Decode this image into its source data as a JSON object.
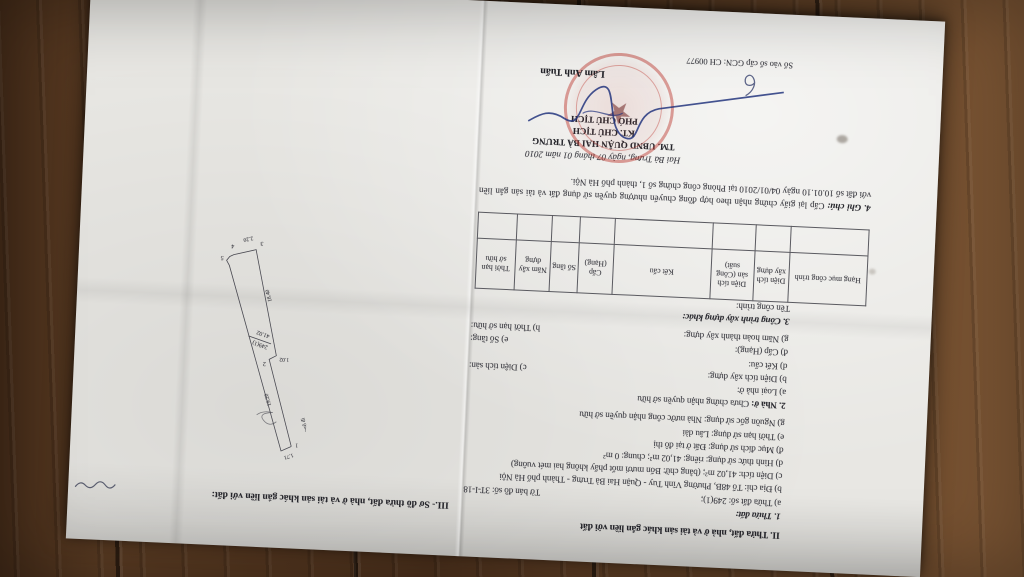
{
  "colors": {
    "paper": "#e8e7e3",
    "wood": "#55371f",
    "stamp_red": "#ba3028",
    "ink_blue": "#23357e"
  },
  "page_left": {
    "section2_heading": "II. Thửa đất, nhà ở và tài sản khác gắn liền với đất",
    "parcel": {
      "title": "1. Thửa đất:",
      "line_a_left": "a) Thửa đất số: 249(1);",
      "line_a_right": "Tờ bản đồ số: 3T-I-18",
      "line_b": "b) Địa chỉ: Tổ 48B, Phường Vĩnh Tuy - Quận Hai Bà Trưng - Thành phố Hà Nội",
      "line_c": "c) Diện tích: 41,02 m²; (bằng chữ: Bốn mươi mốt phẩy không hai mét vuông)",
      "line_d": "d) Hình thức sử dụng: riêng: 41,02 m²; chung: 0 m²",
      "line_dd": "đ) Mục đích sử dụng: Đất ở tại đô thị",
      "line_e": "e) Thời hạn sử dụng: Lâu dài",
      "line_g": "g) Nguồn gốc sử dụng: Nhà nước công nhận quyền sở hữu"
    },
    "house": {
      "title_label": "2. Nhà ở:",
      "title_text": "Chưa chứng nhận quyền sở hữu",
      "line_a": "a) Loại nhà ở:",
      "line_b": "b) Diện tích xây dựng:",
      "line_c": "c) Diện tích sàn:",
      "line_d": "d) Kết cấu:",
      "line_dd": "đ) Cấp (Hạng):",
      "line_e": "e) Số tầng:",
      "line_g": "g) Năm hoàn thành xây dựng:",
      "line_h": "h) Thời hạn sở hữu:"
    },
    "construction": {
      "title": "3. Công trình xây dựng khác:",
      "subtitle": "Tên công trình:",
      "table_headers": [
        "Hạng mục công trình",
        "Diện tích xây dựng",
        "Diện tích sàn (Công suất)",
        "Kết cấu",
        "Cấp (Hạng)",
        "Số tầng",
        "Năm xây dựng",
        "Thời hạn sở hữu"
      ]
    },
    "note_label": "4. Ghi chú:",
    "note_text": "Cấp lại giấy chứng nhận theo hợp đồng chuyển nhượng quyền sử dụng đất và tài sản gắn liền với đất số 10.01.10 ngày 04/01/2010 tại Phòng công chứng số 1, thành phố Hà Nội.",
    "sign": {
      "date_line": "Hai Bà Trưng, ngày 07 tháng 01 năm 2010",
      "authority": "TM. UBND QUẬN HAI BÀ TRƯNG",
      "kt_line": "KT. CHỦ TỊCH",
      "deputy_line": "PHÓ CHỦ TỊCH",
      "signer_name": "Lâm Anh Tuấn"
    },
    "book_number": "Số vào sổ cấp GCN: CH 00977"
  },
  "page_right": {
    "section3_heading": "III.- Sơ đồ thửa đất, nhà ở và tài sản khác gắn liền với đất:",
    "diagram": {
      "parcel_number": "249(1)",
      "area_m2": "41.02",
      "edge_top_width": "1.71",
      "edge_right_length": "19.20",
      "edge_left_length": "18.40",
      "edge_step": "1.02",
      "edge_bottom_width": "2.20",
      "alley_label": "ngõ đi",
      "corner_1": "1",
      "corner_2": "2",
      "corner_3": "3",
      "corner_4": "4",
      "corner_5": "5"
    }
  }
}
